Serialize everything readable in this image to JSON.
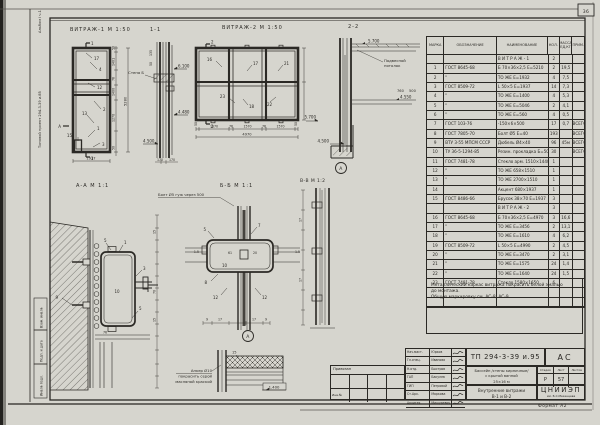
{
  "colors": {
    "paper": "#d6d5ce",
    "ink": "#2b2925"
  },
  "page": {
    "sheet_number": "36",
    "format_note": "Формат А2"
  },
  "margin": {
    "album": "Альбом I ч.1",
    "project": "Типовой проект 294-3-39 и.85",
    "strips": [
      "Взам. инв.№",
      "Подп. и дата",
      "Инв.№ подл."
    ]
  },
  "drawings": {
    "vitrazh1": {
      "title": "ВИТРАЖ-1 М 1:50",
      "marks": [
        "17",
        "4",
        "12",
        "2",
        "13",
        "1",
        "3",
        "15"
      ],
      "dims_right": [
        "50",
        "1401",
        "76",
        "1400",
        "1270",
        "50"
      ],
      "dim_total": "5280",
      "dim_bottom": "1937",
      "cut_top": "1",
      "cut_left": "А"
    },
    "section11": {
      "title": "1-1",
      "levels": [
        "6.100",
        "4.480",
        "4.500"
      ],
      "wall_label": "Стена Б",
      "dims": [
        "135",
        "50",
        "170",
        "170"
      ]
    },
    "vitrazh2": {
      "title": "ВИТРАЖ-2 М 1:50",
      "marks": [
        "16",
        "17",
        "21",
        "23",
        "18",
        "22"
      ],
      "dims_bottom": [
        "50",
        "1570",
        "76",
        "1570",
        "76",
        "1570",
        "50"
      ],
      "dim_total": "4970",
      "cut": "2"
    },
    "section22": {
      "title": "2-2",
      "levels": [
        "5.700",
        "4.550",
        "5.700",
        "4.500"
      ],
      "ceiling_label": [
        "Подвесной",
        "потолок"
      ],
      "dims": [
        "760",
        "500"
      ]
    },
    "sectionAA": {
      "title": "А-А М 1:1",
      "marks": [
        "9",
        "5",
        "1",
        "3",
        "5"
      ],
      "mark_center": "10",
      "dims": [
        "76",
        "15",
        "70",
        "15"
      ]
    },
    "sectionBB": {
      "title": "Б-Б М 1:1",
      "bolt_note": "Болт Ø5 гуж через 500",
      "marks": [
        "5",
        "7",
        "8",
        "12",
        "12"
      ],
      "mark_center": "10",
      "dims": [
        "1.5",
        "61",
        "20",
        "1.5"
      ],
      "bottom_dims": [
        "9",
        "17",
        "17",
        "9"
      ]
    },
    "sectionVV": {
      "title": "В-В М 1:2",
      "dims": [
        "17",
        "17"
      ],
      "detail_ref": "А"
    },
    "detailA": {
      "ref": "А",
      "mark": "15",
      "level": "1.400",
      "note_lines": [
        "Анкер Ø10",
        "покрасить серой",
        "масляной краской"
      ]
    }
  },
  "spec_table": {
    "headers": [
      "МАРКА",
      "ОБОЗНАЧЕНИЕ",
      "НАИМЕНОВАНИЕ",
      "КОЛ.",
      "МАССА ЕД,КГ",
      "ПРИМ."
    ],
    "rows": [
      [
        "",
        "",
        "В И Т Р А Ж - 1",
        "2",
        "",
        ""
      ],
      [
        "1",
        "ГОСТ 8645-68",
        "Б 70×36×2,5 Е=5210",
        "2",
        "19,5",
        ""
      ],
      [
        "2",
        "\"",
        "ТО ЖЕ Е=1932",
        "4",
        "7,5",
        ""
      ],
      [
        "3",
        "ГОСТ 8509-72",
        "L 50×5 Е=1937",
        "14",
        "7,3",
        ""
      ],
      [
        "4",
        "\"",
        "ТО ЖЕ Е=1400",
        "4",
        "5,3",
        ""
      ],
      [
        "5",
        "\"",
        "ТО ЖЕ Е=5046",
        "2",
        "4,1",
        ""
      ],
      [
        "6",
        "\"",
        "ТО ЖЕ Е=560",
        "4",
        "0,5",
        ""
      ],
      [
        "7",
        "ГОСТ 103-76",
        "-150×6×500",
        "17",
        "0,7",
        "ВСЕГО"
      ],
      [
        "8",
        "ГОСТ 7805-70",
        "Болт Ø5 Е=40",
        "193",
        "",
        "ВСЕГО"
      ],
      [
        "9",
        "ВТУ 3-55 МПСМ СССР",
        "Дюбель Ø4×40",
        "96",
        "45м",
        "ВСЕГО"
      ],
      [
        "10",
        "ТУ 36-5-1294-85",
        "Резин. прокладка Б=50",
        "30",
        "",
        "ВСЕГО"
      ],
      [
        "11",
        "ГОСТ 7481-78",
        "Стекло арм. 1510×1440",
        "1",
        "",
        ""
      ],
      [
        "12",
        "\"",
        "ТО ЖЕ 658×1510",
        "1",
        "",
        ""
      ],
      [
        "13",
        "\"",
        "ТО ЖЕ 2700×1510",
        "1",
        "",
        ""
      ],
      [
        "14",
        "",
        "Акцент 680×1937",
        "1",
        "",
        ""
      ],
      [
        "15",
        "ГОСТ 8486-66",
        "Брусок 38×70 Е=1937",
        "3",
        "",
        ""
      ],
      [
        "",
        "",
        "В И Т Р А Ж - 2",
        "3",
        "",
        ""
      ],
      [
        "16",
        "ГОСТ 8645-68",
        "Б 70×36×2,5 Е=4970",
        "3",
        "16,6",
        ""
      ],
      [
        "17",
        "\"",
        "ТО ЖЕ Е=3456",
        "2",
        "13,1",
        ""
      ],
      [
        "18",
        "\"",
        "ТО ЖЕ Е=1610",
        "4",
        "6,2",
        ""
      ],
      [
        "19",
        "ГОСТ 8509-72",
        "L 50×5 Е=4990",
        "2",
        "4,5",
        ""
      ],
      [
        "20",
        "\"",
        "ТО ЖЕ Е=3470",
        "2",
        "3,1",
        ""
      ],
      [
        "21",
        "\"",
        "ТО ЖЕ Е=1575",
        "24",
        "1,4",
        ""
      ],
      [
        "22",
        "\"",
        "ТО ЖЕ Е=1640",
        "24",
        "1,5",
        ""
      ],
      [
        "23",
        "ГОСТ 7481-78",
        "Стекло 1580×1650",
        "6",
        "",
        ""
      ],
      [
        "",
        "",
        "",
        "",
        "",
        ""
      ],
      [
        "",
        "",
        "",
        "",
        "",
        ""
      ]
    ]
  },
  "notes": {
    "lines": [
      "Металлический каркас витража покрасить белой эмалью",
      "до монтажа.",
      "Общую маркировку см. АС-8; АС-9."
    ]
  },
  "title_block": {
    "doc_number": "ТП 294-3-39 и.95",
    "doc_code": "АС",
    "object_lines": [
      "Бассейн /стены кирпичные/",
      "с крытой ванной",
      "25×16 м"
    ],
    "stage_label": "Стадия",
    "sheet_label": "Лист",
    "sheets_label": "Листов",
    "stage": "Р",
    "sheet": "57",
    "sheets": "",
    "sheet_title_lines": [
      "Внутренние витражи",
      "В-1 и В-2"
    ],
    "org": "ЦНИИЭП",
    "org_sub": "им. Б.С.Мезенцева",
    "left_label": "Привязан",
    "inv_label": "Инв.№",
    "signatures": [
      {
        "role": "Нач.маст.",
        "name": "Юрков"
      },
      {
        "role": "Гл.спец.",
        "name": "Иванова"
      },
      {
        "role": "Н.отд.",
        "name": "Быстров"
      },
      {
        "role": "ГАП",
        "name": "Бакулев"
      },
      {
        "role": "ГИП",
        "name": "Петровой"
      },
      {
        "role": "Ст.Арх.",
        "name": "Маркова"
      },
      {
        "role": "Архитек.",
        "name": "Мишуревич"
      }
    ]
  }
}
